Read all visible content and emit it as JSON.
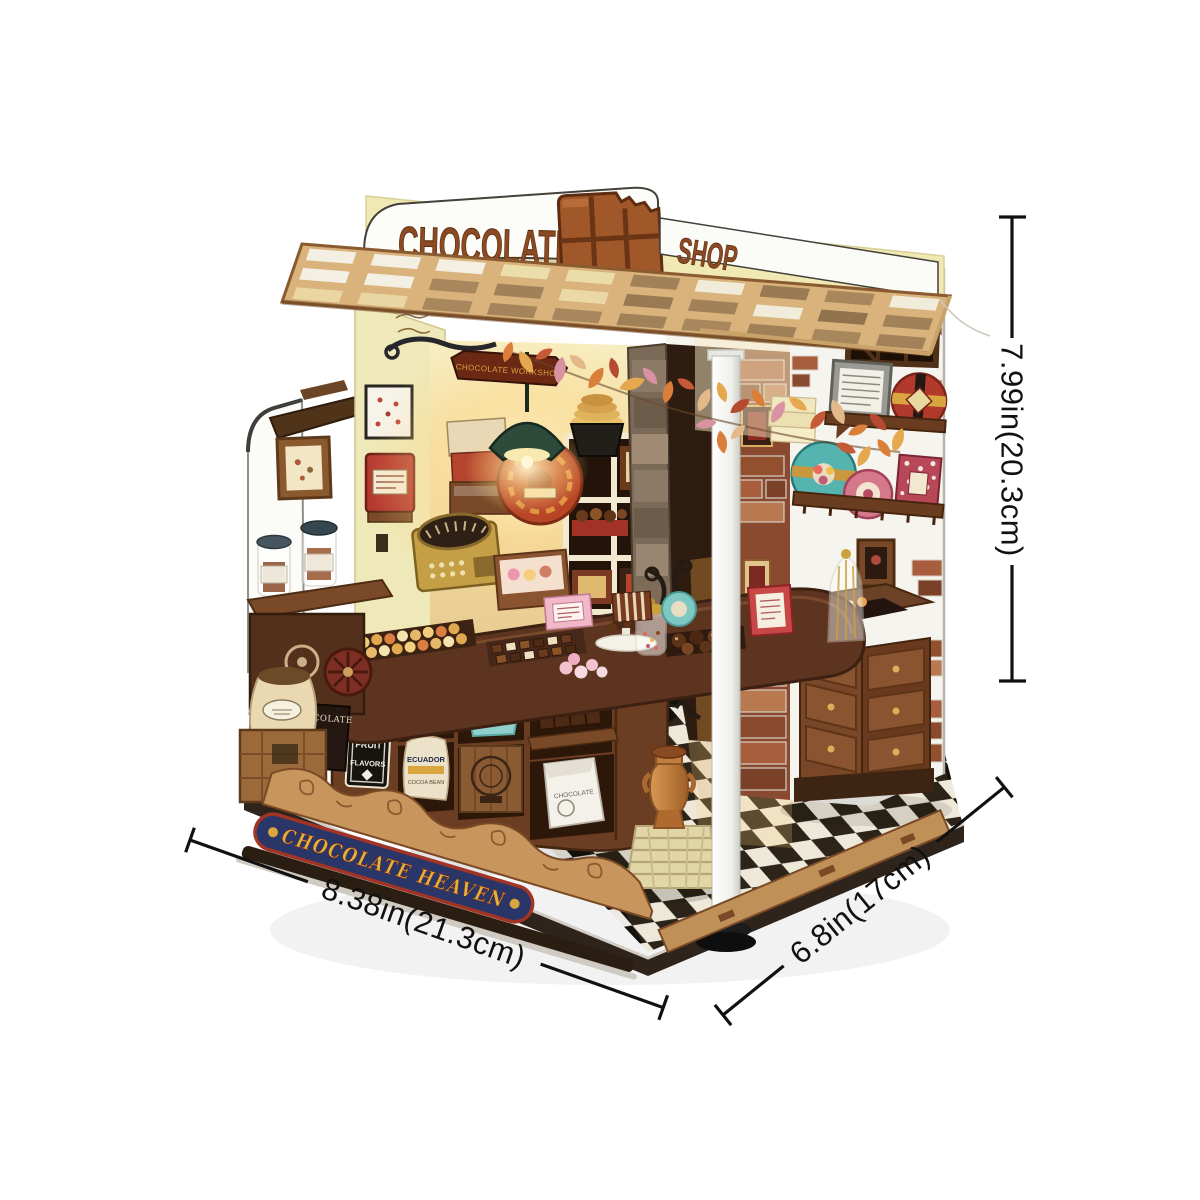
{
  "product": {
    "kind": "DIY miniature chocolate-shop booth kit photo",
    "marquee": {
      "left": "CHOCOLATE",
      "right": "SHOP",
      "icon": "bitten-chocolate-bar"
    },
    "hanging_sign": "CHOCOLATE WORKSHOP",
    "base_banner": "CHOCOLATE HEAVEN",
    "chalkboard_lines": [
      "FRUIT",
      "AND",
      "DRIED",
      "FRUIT",
      "FLAVORS"
    ],
    "crate_labels": {
      "sack_upper": "NIGERIA",
      "sack_lower_line1": "ECUADOR",
      "sack_lower_line2": "COCOA BEAN",
      "paper_bag": "CHOCOLATE"
    },
    "cabinet_sign": "YELENA CHOCOLATE"
  },
  "dimensions": {
    "height_label": "7.99in(20.3cm)",
    "width_label": "8.38in(21.3cm)",
    "depth_label": "6.8in(17cm)"
  },
  "palette": {
    "background": "#ffffff",
    "dimension_line": "#111111",
    "sign_brown": "#8a4a22",
    "awning_wood": "#d9b27c",
    "wall_cream": "#efe8b8",
    "banner_navy": "#2a3668",
    "banner_gold": "#e2b33c",
    "banner_border_red": "#a03425",
    "lamp_green": "#2e4a3a",
    "bucket_teal": "#8fd0cc",
    "floor_black": "#17120e",
    "floor_white": "#efece4"
  }
}
